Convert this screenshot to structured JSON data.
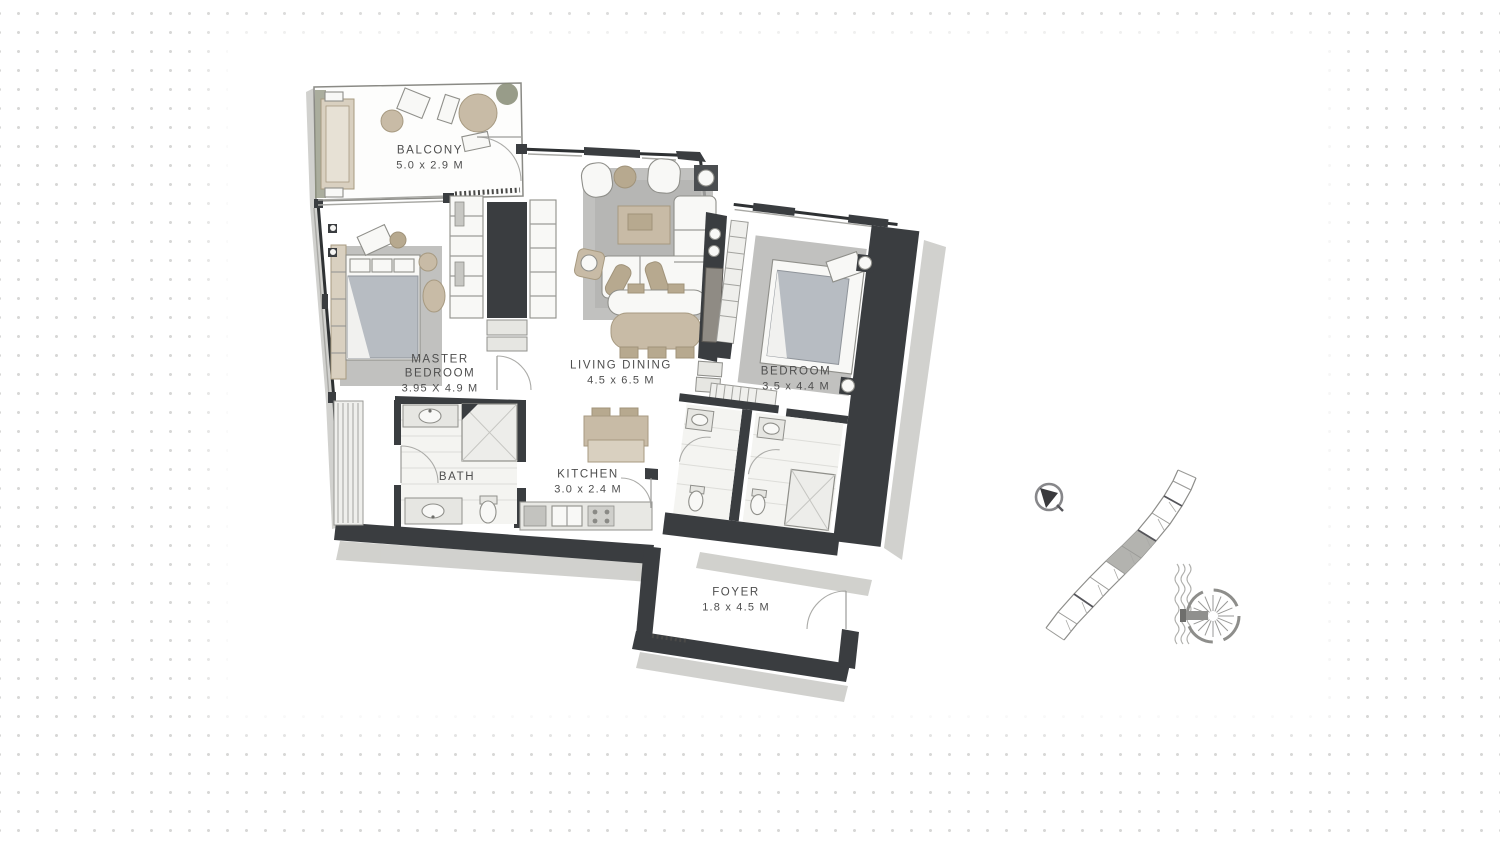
{
  "floor_plan": {
    "rooms": [
      {
        "id": "balcony",
        "name": "BALCONY",
        "dims": "5.0 x 2.9 M"
      },
      {
        "id": "master-bedroom",
        "name": "MASTER BEDROOM",
        "dims": "3.95 X 4.9 M"
      },
      {
        "id": "living-dining",
        "name": "LIVING DINING",
        "dims": "4.5 x 6.5 M"
      },
      {
        "id": "bedroom",
        "name": "BEDROOM",
        "dims": "3.5 x 4.4 M"
      },
      {
        "id": "bath",
        "name": "BATH",
        "dims": ""
      },
      {
        "id": "kitchen",
        "name": "KITCHEN",
        "dims": "3.0 x 2.4 M"
      },
      {
        "id": "foyer",
        "name": "FOYER",
        "dims": "1.8 x 4.5 M"
      }
    ],
    "style": "hand-drawn architectural plan, charcoal walls, tan furniture"
  },
  "location_map": {
    "compass_icon": "north-arrow",
    "building_shape": "crescent-tower-footprint",
    "highlighted_unit": "mid-crescent",
    "water_icon": "waves",
    "palm_icon": "palm-jumeirah"
  },
  "colors": {
    "wall": "#3a3d40",
    "shadow": "#c9c9c5",
    "rug": "#b1b1af",
    "furniture_tan": "#c8bba6",
    "label_text": "#4e4e4e",
    "dot_grid": "#d7d7d6"
  }
}
